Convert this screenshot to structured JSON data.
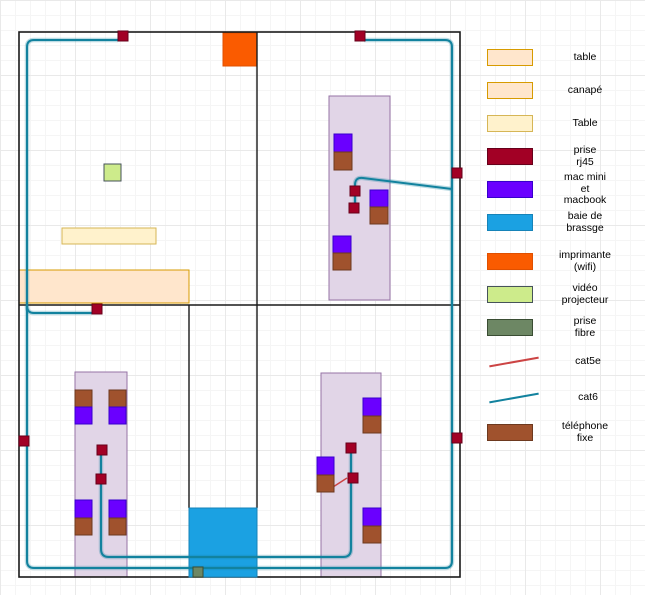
{
  "palette": {
    "wall": {
      "fill": "#1a1a1a"
    },
    "desk": {
      "fill": "#e1d5e7",
      "stroke": "#9673a6"
    },
    "table": {
      "fill": "#ffe6cc",
      "stroke": "#d79b00"
    },
    "table2": {
      "fill": "#fff2cc",
      "stroke": "#d6b656"
    },
    "rj45": {
      "fill": "#a20025",
      "stroke": "#66001a"
    },
    "mac": {
      "fill": "#6a00ff",
      "stroke": "#3700cc"
    },
    "baie": {
      "fill": "#1ba1e2",
      "stroke": "#1683b8"
    },
    "imprimante": {
      "fill": "#fa5b00",
      "stroke": "#e05000"
    },
    "video": {
      "fill": "#cdeb8b",
      "stroke": "#46535a"
    },
    "fibre": {
      "fill": "#6d8764",
      "stroke": "#3a4d33"
    },
    "phone": {
      "fill": "#a0522d",
      "stroke": "#6d391f"
    },
    "cat5e": {
      "fill": "#cc4444"
    },
    "cat6": {
      "fill": "#12829e"
    }
  },
  "legend": {
    "items": [
      {
        "kind": "table",
        "label": "table"
      },
      {
        "kind": "table",
        "label": "canapé"
      },
      {
        "kind": "table2",
        "label": "Table"
      },
      {
        "kind": "rj45",
        "label": "prise\nrj45"
      },
      {
        "kind": "mac",
        "label": "mac mini\net\nmacbook"
      },
      {
        "kind": "baie",
        "label": "baie de\nbrassge"
      },
      {
        "kind": "imprimante",
        "label": "imprimante\n(wifi)"
      },
      {
        "kind": "video",
        "label": "vidéo\nprojecteur"
      },
      {
        "kind": "fibre",
        "label": "prise\nfibre"
      },
      {
        "kind": "cat5e",
        "label": "cat5e"
      },
      {
        "kind": "cat6",
        "label": "cat6"
      },
      {
        "kind": "phone",
        "label": "téléphone\nfixe"
      }
    ]
  },
  "plan": {
    "walls": {
      "outer": {
        "x": 19,
        "y": 32,
        "w": 441,
        "h": 545
      },
      "inner": [
        {
          "x1": 257,
          "y1": 32,
          "x2": 257,
          "y2": 305
        },
        {
          "x1": 19,
          "y1": 305,
          "x2": 460,
          "y2": 305
        },
        {
          "x1": 189,
          "y1": 305,
          "x2": 189,
          "y2": 508
        },
        {
          "x1": 257,
          "y1": 305,
          "x2": 257,
          "y2": 508
        }
      ]
    },
    "furniture": [
      {
        "name": "desk-area-top-right",
        "kind": "desk",
        "x": 329,
        "y": 96,
        "w": 61,
        "h": 204
      },
      {
        "name": "desk-area-bottom-left",
        "kind": "desk",
        "x": 75,
        "y": 372,
        "w": 52,
        "h": 205
      },
      {
        "name": "desk-area-bottom-right",
        "kind": "desk",
        "x": 321,
        "y": 373,
        "w": 60,
        "h": 204
      },
      {
        "name": "table-small",
        "kind": "table2",
        "x": 62,
        "y": 228,
        "w": 94,
        "h": 16
      },
      {
        "name": "canape",
        "kind": "table",
        "x": 19,
        "y": 270,
        "w": 170,
        "h": 33
      },
      {
        "name": "imprimante-wifi",
        "kind": "imprimante",
        "x": 223,
        "y": 33,
        "w": 34,
        "h": 33
      },
      {
        "name": "video-projecteur",
        "kind": "video",
        "x": 104,
        "y": 164,
        "w": 17,
        "h": 17
      },
      {
        "name": "baie-de-brassage",
        "kind": "baie",
        "x": 189,
        "y": 508,
        "w": 68,
        "h": 69
      }
    ],
    "cables": [
      {
        "kind": "cat6",
        "path": "M364,40 H445 Q452,40 452,47 V561 Q452,568 445,568 H34 Q27,568 27,561 V47 Q27,40 34,40 H118"
      },
      {
        "kind": "cat6",
        "path": "M27,306 Q27,313 34,313 H92"
      },
      {
        "kind": "cat6",
        "path": "M452,189 L363,178 Q355,177 355,185 V206"
      },
      {
        "kind": "cat6",
        "path": "M101,450 V549 Q101,557 109,557 H343 Q351,557 351,549 V448"
      },
      {
        "kind": "cat5e",
        "path": "M333,487 L347,478"
      }
    ],
    "devices": [
      {
        "k": "mac",
        "x": 334,
        "y": 134,
        "w": 18,
        "h": 18
      },
      {
        "k": "phone",
        "x": 334,
        "y": 152,
        "w": 18,
        "h": 18
      },
      {
        "k": "mac",
        "x": 370,
        "y": 190,
        "w": 18,
        "h": 17
      },
      {
        "k": "phone",
        "x": 370,
        "y": 207,
        "w": 18,
        "h": 17
      },
      {
        "k": "mac",
        "x": 333,
        "y": 236,
        "w": 18,
        "h": 17
      },
      {
        "k": "phone",
        "x": 333,
        "y": 253,
        "w": 18,
        "h": 17
      },
      {
        "k": "phone",
        "x": 75,
        "y": 390,
        "w": 17,
        "h": 17
      },
      {
        "k": "mac",
        "x": 75,
        "y": 407,
        "w": 17,
        "h": 17
      },
      {
        "k": "phone",
        "x": 109,
        "y": 390,
        "w": 17,
        "h": 17
      },
      {
        "k": "mac",
        "x": 109,
        "y": 407,
        "w": 17,
        "h": 17
      },
      {
        "k": "mac",
        "x": 75,
        "y": 500,
        "w": 17,
        "h": 18
      },
      {
        "k": "phone",
        "x": 75,
        "y": 518,
        "w": 17,
        "h": 17
      },
      {
        "k": "mac",
        "x": 109,
        "y": 500,
        "w": 17,
        "h": 18
      },
      {
        "k": "phone",
        "x": 109,
        "y": 518,
        "w": 17,
        "h": 17
      },
      {
        "k": "mac",
        "x": 363,
        "y": 398,
        "w": 18,
        "h": 18
      },
      {
        "k": "phone",
        "x": 363,
        "y": 416,
        "w": 18,
        "h": 17
      },
      {
        "k": "mac",
        "x": 317,
        "y": 457,
        "w": 17,
        "h": 18
      },
      {
        "k": "phone",
        "x": 317,
        "y": 475,
        "w": 17,
        "h": 17
      },
      {
        "k": "mac",
        "x": 363,
        "y": 508,
        "w": 18,
        "h": 18
      },
      {
        "k": "phone",
        "x": 363,
        "y": 526,
        "w": 18,
        "h": 17
      }
    ],
    "outlets_rj45": [
      [
        118,
        31
      ],
      [
        355,
        31
      ],
      [
        452,
        168
      ],
      [
        452,
        433
      ],
      [
        19,
        436
      ],
      [
        92,
        304
      ],
      [
        350,
        186
      ],
      [
        349,
        203
      ],
      [
        97,
        445
      ],
      [
        96,
        474
      ],
      [
        346,
        443
      ],
      [
        348,
        473
      ]
    ],
    "outlet_fibre": {
      "x": 193,
      "y": 567,
      "w": 10,
      "h": 10
    }
  }
}
